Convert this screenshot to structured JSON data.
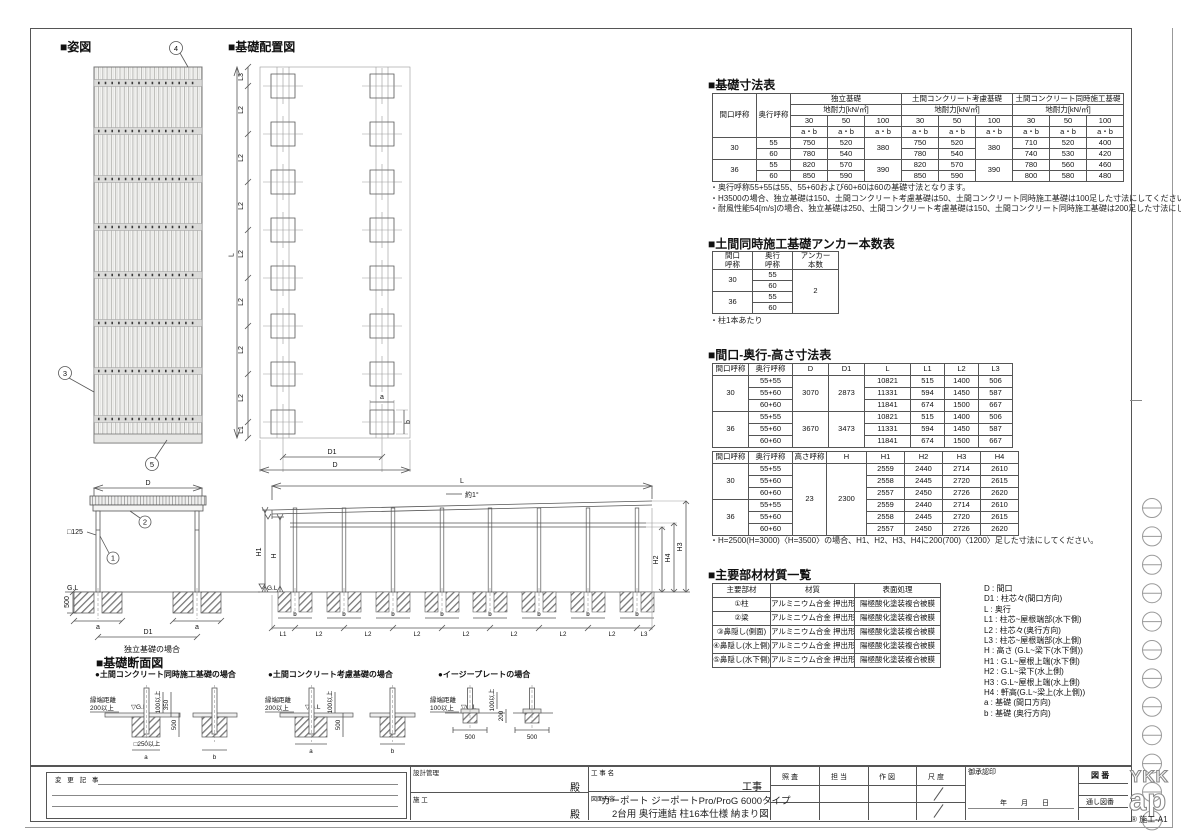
{
  "section_headers": {
    "appearance": "■姿図",
    "foundation_layout": "■基礎配置図",
    "foundation_dims": "■基礎寸法表",
    "anchor": "■土間同時施工基礎アンカー本数表",
    "dims": "■間口-奥行-高さ寸法表",
    "materials": "■主要部材材質一覧",
    "foundation_section": "■基礎断面図"
  },
  "labels": {
    "D": "D",
    "D1": "D1",
    "L": "L",
    "L1": "L1",
    "L2": "L2",
    "L3": "L3",
    "H": "H",
    "H1": "H1",
    "H2": "H2",
    "H3": "H3",
    "H4": "H4",
    "a": "a",
    "b": "b",
    "GL": "G.L",
    "GLd": "▽G.L",
    "deg": "約1°",
    "box125": "□125",
    "d500": "500",
    "n1": "1",
    "n2": "2",
    "n3": "3",
    "n4": "4",
    "n5": "5",
    "independent": "独立基礎の場合"
  },
  "tables": {
    "foundation": {
      "widths": [
        44,
        34,
        37,
        37,
        37,
        37,
        37,
        37,
        37,
        37,
        37
      ],
      "rows": [
        [
          {
            "t": "間口呼称",
            "rs": 4
          },
          {
            "t": "奥行呼称",
            "rs": 4
          },
          {
            "t": "独立基礎",
            "cs": 3
          },
          {
            "t": "土間コンクリート考慮基礎",
            "cs": 3
          },
          {
            "t": "土間コンクリート同時施工基礎",
            "cs": 3
          }
        ],
        [
          {
            "t": "地耐力[kN/㎡]",
            "cs": 3
          },
          {
            "t": "地耐力[kN/㎡]",
            "cs": 3
          },
          {
            "t": "地耐力[kN/㎡]",
            "cs": 3
          }
        ],
        [
          "30",
          "50",
          "100",
          "30",
          "50",
          "100",
          "30",
          "50",
          "100"
        ],
        [
          "a・b",
          "a・b",
          "a・b",
          "a・b",
          "a・b",
          "a・b",
          "a・b",
          "a・b",
          "a・b"
        ],
        [
          {
            "t": "30",
            "rs": 2
          },
          "55",
          "750",
          "520",
          {
            "t": "380",
            "rs": 2
          },
          "750",
          "520",
          {
            "t": "380",
            "rs": 2
          },
          "710",
          "520",
          "400"
        ],
        [
          "60",
          "780",
          "540",
          "780",
          "540",
          "740",
          "530",
          "420"
        ],
        [
          {
            "t": "36",
            "rs": 2
          },
          "55",
          "820",
          "570",
          {
            "t": "390",
            "rs": 2
          },
          "820",
          "570",
          {
            "t": "390",
            "rs": 2
          },
          "780",
          "560",
          "460"
        ],
        [
          "60",
          "850",
          "590",
          "850",
          "590",
          "800",
          "580",
          "480"
        ]
      ],
      "notes": "・奥行呼称55+55は55、55+60および60+60は60の基礎寸法となります。\n・H3500の場合、独立基礎は150、土間コンクリート考慮基礎は50、土間コンクリート同時施工基礎は100足した寸法にしてください。\n・耐風性能54[m/s]の場合、独立基礎は250、土間コンクリート考慮基礎は150、土間コンクリート同時施工基礎は200足した寸法にしてください。"
    },
    "anchor": {
      "widths": [
        40,
        40,
        46
      ],
      "rows": [
        [
          "間口\n呼称",
          "奥行\n呼称",
          "アンカー\n本数"
        ],
        [
          {
            "t": "30",
            "rs": 2
          },
          "55",
          {
            "t": "2",
            "rs": 4
          }
        ],
        [
          "60"
        ],
        [
          {
            "t": "36",
            "rs": 2
          },
          "55"
        ],
        [
          "60"
        ]
      ],
      "note": "・柱1本あたり"
    },
    "dims_a": {
      "widths": [
        36,
        44,
        36,
        36,
        46,
        34,
        34,
        34
      ],
      "rows": [
        [
          "間口呼称",
          "奥行呼称",
          "D",
          "D1",
          "L",
          "L1",
          "L2",
          "L3"
        ],
        [
          {
            "t": "30",
            "rs": 3
          },
          "55+55",
          {
            "t": "3070",
            "rs": 3
          },
          {
            "t": "2873",
            "rs": 3
          },
          "10821",
          "515",
          "1400",
          "506"
        ],
        [
          "55+60",
          "11331",
          "594",
          "1450",
          "587"
        ],
        [
          "60+60",
          "11841",
          "674",
          "1500",
          "667"
        ],
        [
          {
            "t": "36",
            "rs": 3
          },
          "55+55",
          {
            "t": "3670",
            "rs": 3
          },
          {
            "t": "3473",
            "rs": 3
          },
          "10821",
          "515",
          "1400",
          "506"
        ],
        [
          "55+60",
          "11331",
          "594",
          "1450",
          "587"
        ],
        [
          "60+60",
          "11841",
          "674",
          "1500",
          "667"
        ]
      ]
    },
    "dims_b": {
      "widths": [
        36,
        44,
        34,
        40,
        38,
        38,
        38,
        38
      ],
      "rows": [
        [
          "間口呼称",
          "奥行呼称",
          "高さ呼称",
          "H",
          "H1",
          "H2",
          "H3",
          "H4"
        ],
        [
          {
            "t": "30",
            "rs": 3
          },
          "55+55",
          {
            "t": "23",
            "rs": 6
          },
          {
            "t": "2300",
            "rs": 6
          },
          "2559",
          "2440",
          "2714",
          "2610"
        ],
        [
          "55+60",
          "2558",
          "2445",
          "2720",
          "2615"
        ],
        [
          "60+60",
          "2557",
          "2450",
          "2726",
          "2620"
        ],
        [
          {
            "t": "36",
            "rs": 3
          },
          "55+55",
          "2559",
          "2440",
          "2714",
          "2610"
        ],
        [
          "55+60",
          "2558",
          "2445",
          "2720",
          "2615"
        ],
        [
          "60+60",
          "2557",
          "2450",
          "2726",
          "2620"
        ]
      ],
      "note": "・H=2500(H=3000)〈H=3500〉の場合、H1、H2、H3、H4に200(700)〈1200〉足した寸法にしてください。"
    },
    "materials": {
      "widths": [
        58,
        84,
        86
      ],
      "rows": [
        [
          "主要部材",
          "材質",
          "表面処理"
        ],
        [
          "①柱",
          "アルミニウム合金 押出形材",
          "陽極酸化塗装複合被膜"
        ],
        [
          "②梁",
          "アルミニウム合金 押出形材",
          "陽極酸化塗装複合被膜"
        ],
        [
          "③鼻隠し(側面)",
          "アルミニウム合金 押出形材",
          "陽極酸化塗装複合被膜"
        ],
        [
          "④鼻隠し(水上側)",
          "アルミニウム合金 押出形材",
          "陽極酸化塗装複合被膜"
        ],
        [
          "⑤鼻隠し(水下側)",
          "アルミニウム合金 押出形材",
          "陽極酸化塗装複合被膜"
        ]
      ]
    }
  },
  "legend": {
    "lines": [
      "D : 間口",
      "D1 : 柱芯々(間口方向)",
      "L : 奥行",
      "L1 : 柱芯~屋根端部(水下側)",
      "L2 : 柱芯々(奥行方向)",
      "L3 : 柱芯~屋根端部(水上側)",
      "H : 高さ (G.L~梁下(水下側))",
      "H1 : G.L~屋根上端(水下側)",
      "H2 : G.L~梁下(水上側)",
      "H3 : G.L~屋根上端(水上側)",
      "H4 : 軒高(G.L~梁上(水上側))",
      "a : 基礎 (間口方向)",
      "b : 基礎 (奥行方向)"
    ]
  },
  "sections": {
    "s1": {
      "title": "●土間コンクリート同時施工基礎の場合",
      "edge1": "縁端距離",
      "edge2": "200以上",
      "gl": "▽G.L",
      "d100": "100以上",
      "d350": "350",
      "d500": "500",
      "d250": "□250以上",
      "a": "a",
      "b": "b"
    },
    "s2": {
      "title": "●土間コンクリート考慮基礎の場合",
      "edge1": "縁端距離",
      "edge2": "200以上",
      "gl": "▽G.L",
      "d100": "100以上",
      "d500": "500",
      "a": "a",
      "b": "b"
    },
    "s3": {
      "title": "●イージープレートの場合",
      "edge1": "縁端距離",
      "edge2": "100以上",
      "gl": "▽G.L",
      "d100": "100以上",
      "d200": "200",
      "w500a": "500",
      "w500b": "500"
    }
  },
  "title_block": {
    "change_label": "変 更 記 事",
    "design_label": "設計管理",
    "construction_label": "施  工",
    "dono1": "殿",
    "dono2": "殿",
    "project_label": "工 事 名",
    "project_suffix": "工事",
    "content_label": "図面内容",
    "title_line1": "カーポート ジーポートPro/ProG 6000タイプ",
    "title_line2": "2台用 奥行連結 柱16本仕様 納まり図",
    "check_cols": [
      "照 査",
      "担 当",
      "作 図",
      "尺 度"
    ],
    "approval_label": "御承認印",
    "date_label": "年　　月　　日",
    "zuban_label": "図 番",
    "tooshi_label": "通し図番",
    "logo_top": "YKK",
    "logo_bottom": "ap",
    "sheet_code": "® 施工-A1"
  }
}
